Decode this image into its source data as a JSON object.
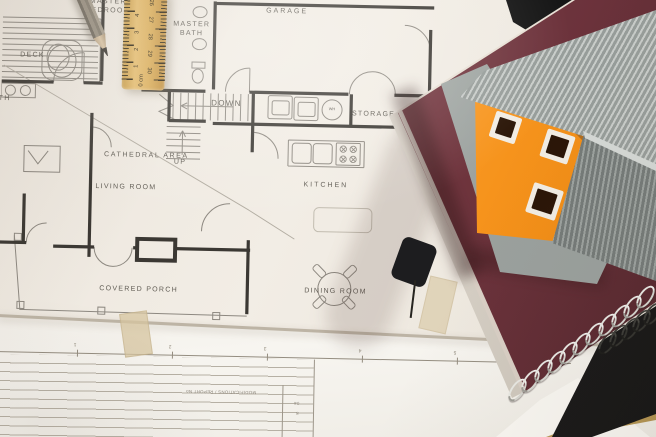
{
  "plan": {
    "rooms": {
      "deck": "DECK",
      "master_bedroom_line1": "MASTER",
      "master_bedroom_line2": "BEDROOM",
      "master_bath_line1": "MASTER",
      "master_bath_line2": "BATH",
      "garage": "GARAGE",
      "down": "DOWN",
      "up": "UP",
      "storage": "STORAGE",
      "cathedral_area": "CATHEDRAL AREA",
      "living_room": "LIVING ROOM",
      "kitchen": "KITCHEN",
      "covered_porch": "COVERED PORCH",
      "dining_room": "DINING ROOM",
      "bath_partial": "BATH",
      "water_heater": "WH"
    }
  },
  "ruler": {
    "left_scale": [
      "5",
      "4",
      "3",
      "2",
      "1",
      "0 cm"
    ],
    "right_scale": [
      "26",
      "27",
      "28",
      "29",
      "30"
    ]
  },
  "title_block": {
    "revision_header": "MODIFICATIONS / REPORT No",
    "cells": [
      "04",
      "8"
    ],
    "border_ticks": [
      "1",
      "2",
      "3",
      "4",
      "5",
      "6"
    ]
  },
  "colors": {
    "paper": "#ece6dd",
    "paper_lower": "#f1ede6",
    "plan_wall": "#3b3833",
    "plan_thin": "#8d8880",
    "label_text": "#5e5a52",
    "ruler_wood": "#dcae58",
    "pencil_body": "#968d7e",
    "notebook_maroon": "#6b323b",
    "notebook_black": "#161616",
    "house_orange": "#f28a0f",
    "roof_gray": "#a7acaa",
    "coil_silver": "#e9e9e6",
    "tape": "#d7c6a0"
  }
}
